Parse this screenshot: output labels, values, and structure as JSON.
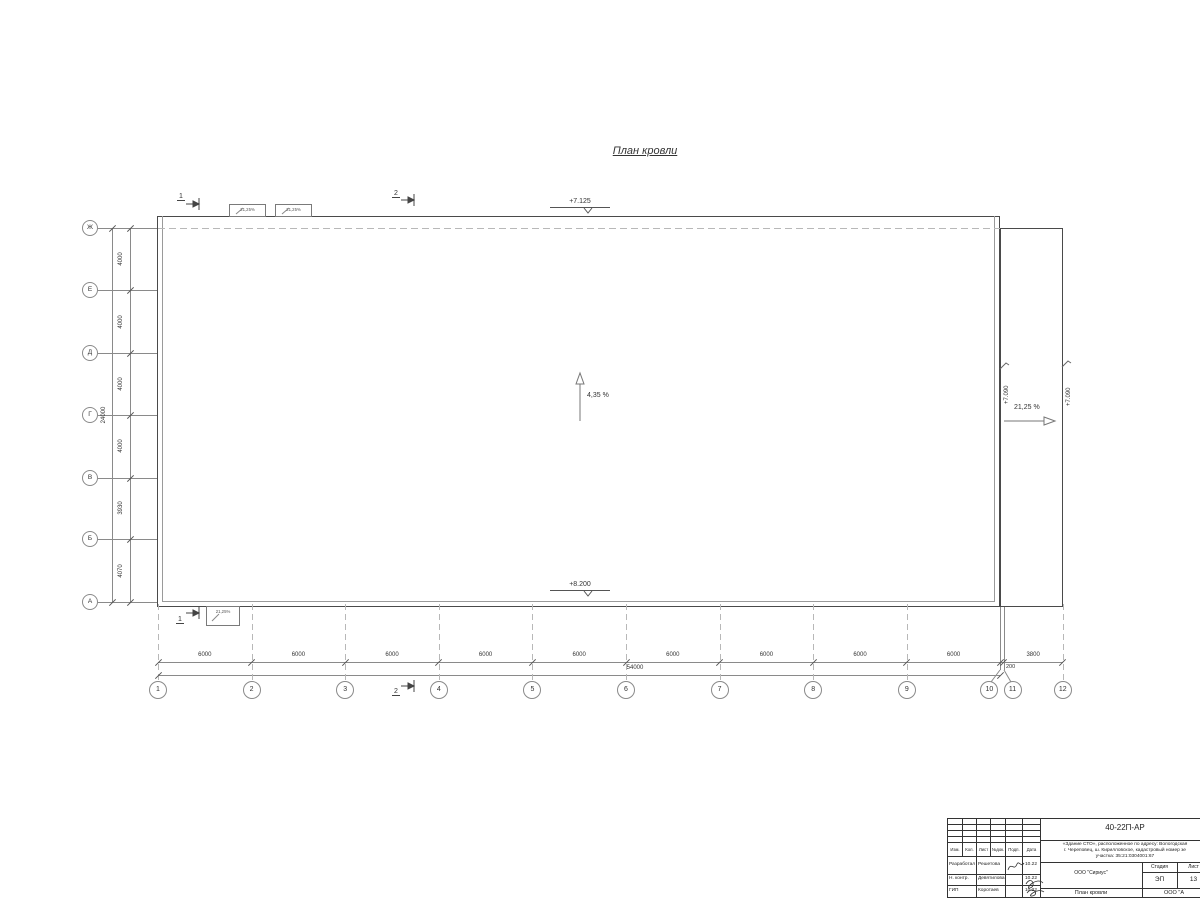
{
  "drawing": {
    "title": "План кровли"
  },
  "axes": {
    "left_labels": [
      "Ж",
      "Е",
      "Д",
      "Г",
      "В",
      "Б",
      "А"
    ],
    "left_spacings_mm": [
      4000,
      4000,
      4000,
      4000,
      3930,
      4070
    ],
    "left_total": "24000",
    "bottom_labels": [
      "1",
      "2",
      "3",
      "4",
      "5",
      "6",
      "7",
      "8",
      "9",
      "10",
      "11",
      "12"
    ],
    "bottom_spacings_mm": [
      6000,
      6000,
      6000,
      6000,
      6000,
      6000,
      6000,
      6000,
      6000,
      200,
      3800
    ],
    "bottom_total": "54000"
  },
  "annotations": {
    "elevation_top": "+7.125",
    "elevation_bottom": "+8.200",
    "elevation_right_a": "+7.090",
    "elevation_right_b": "+7.090",
    "slope_main": "4,35 %",
    "slope_right": "21,25 %",
    "canopy_slope": "21,25%"
  },
  "sections": {
    "top_left": "1",
    "top_mid": "2",
    "bottom_left": "1",
    "bottom_mid": "2"
  },
  "title_block": {
    "doc_number": "40-22П-АР",
    "project_desc_line1": "«Здание СТО», расположенное по адресу: Вологодская",
    "project_desc_line2": "г. Череповец, ш. Кирилловское, кадастровый номер зе",
    "project_desc_line3": "участка: 35:21:0304001:67",
    "header_cols": [
      "Изм.",
      "Кол.",
      "Лист",
      "№док.",
      "Подп.",
      "Дата"
    ],
    "rows": [
      {
        "role": "Разработал",
        "name": "Решетова",
        "date": "10.22"
      },
      {
        "role": "Н. контр.",
        "name": "Девятилова",
        "date": "10.22"
      },
      {
        "role": "ГИП",
        "name": "Коротаев",
        "date": "10.22"
      }
    ],
    "org": "ООО \"Сириус\"",
    "stage_label": "Стадия",
    "sheet_label": "Лист",
    "stage_value": "ЭП",
    "sheet_value": "13",
    "sheet_title": "План кровли",
    "org2": "ООО \"А"
  }
}
